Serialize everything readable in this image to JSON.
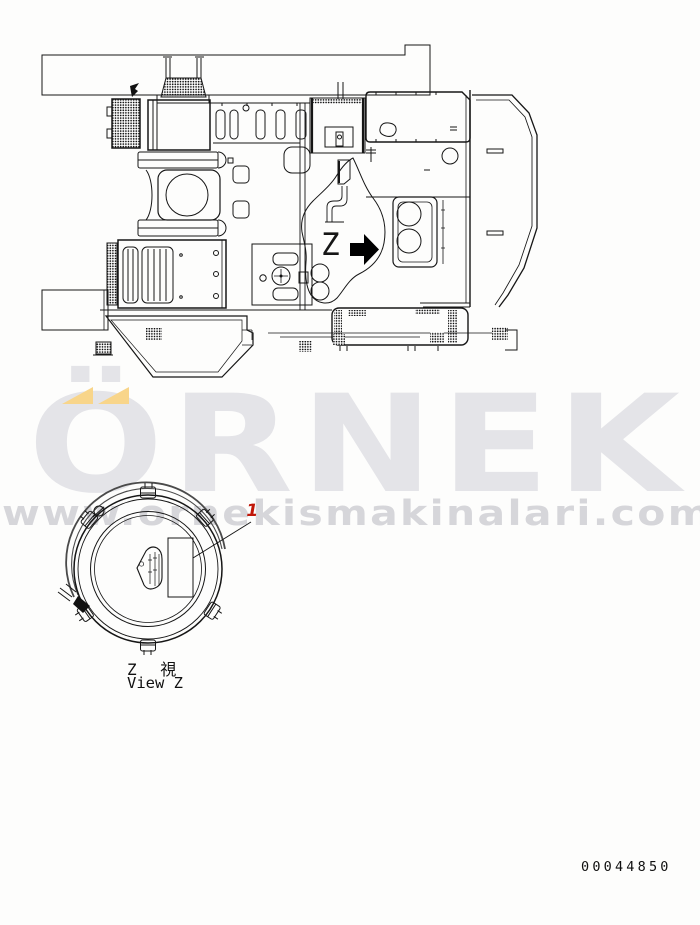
{
  "diagram": {
    "z_marker": "Z",
    "arrow_color": "#000000",
    "line_color": "#161616"
  },
  "detail_view": {
    "label_cjk": "Z 視",
    "label_en": "View Z",
    "callout": {
      "number": "1",
      "color": "#c01608"
    }
  },
  "watermark": {
    "brand": "ÖRNEK",
    "url": "www.ornekismakinalari.com.tr",
    "brand_color": "#e4e4e8",
    "url_color": "#d6d6da",
    "accent_color": "#f8d58a"
  },
  "footer": {
    "document_number": "00044850"
  }
}
